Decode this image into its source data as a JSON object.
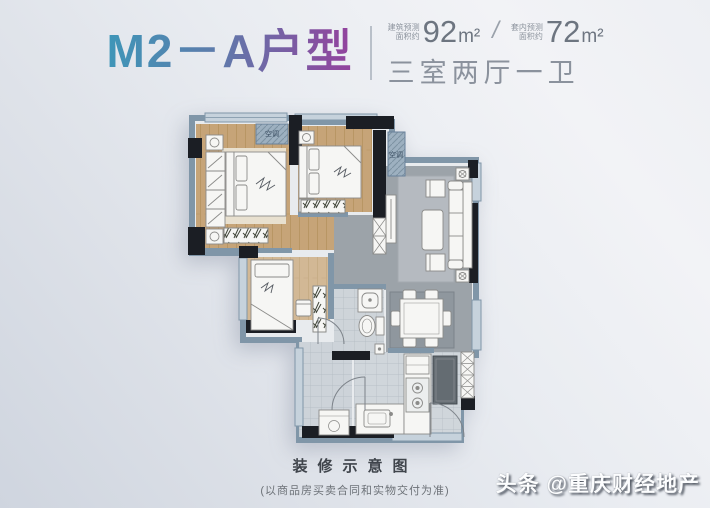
{
  "header": {
    "title": "M2－A户型",
    "title_gradient_start": "#3e96b8",
    "title_gradient_end": "#94419d",
    "area_primary": {
      "label_line1": "建筑预测",
      "label_line2": "面积约",
      "value": "92",
      "unit": "m²"
    },
    "separator": "/",
    "area_secondary": {
      "label_line1": "套内预测",
      "label_line2": "面积约",
      "value": "72",
      "unit": "m²"
    },
    "layout_text": "三室两厅一卫"
  },
  "plan": {
    "ac_label": "空调",
    "colors": {
      "wall_blue": "#8096a8",
      "wall_dark": "#1b1e24",
      "window": "#c6d2dc",
      "wood_floor": "#c6a478",
      "gray_floor": "#9ca3a9",
      "living_rug": "#b5bac0",
      "dining_rug": "#8f979e",
      "tile_floor": "#ced4d9",
      "furniture": "#f6f6f4",
      "fridge_dark": "#646c72"
    }
  },
  "footer": {
    "caption": "装修示意图",
    "note": "(以商品房买卖合同和实物交付为准)"
  },
  "watermark": {
    "prefix": "头条",
    "handle": "@重庆财经地产"
  }
}
